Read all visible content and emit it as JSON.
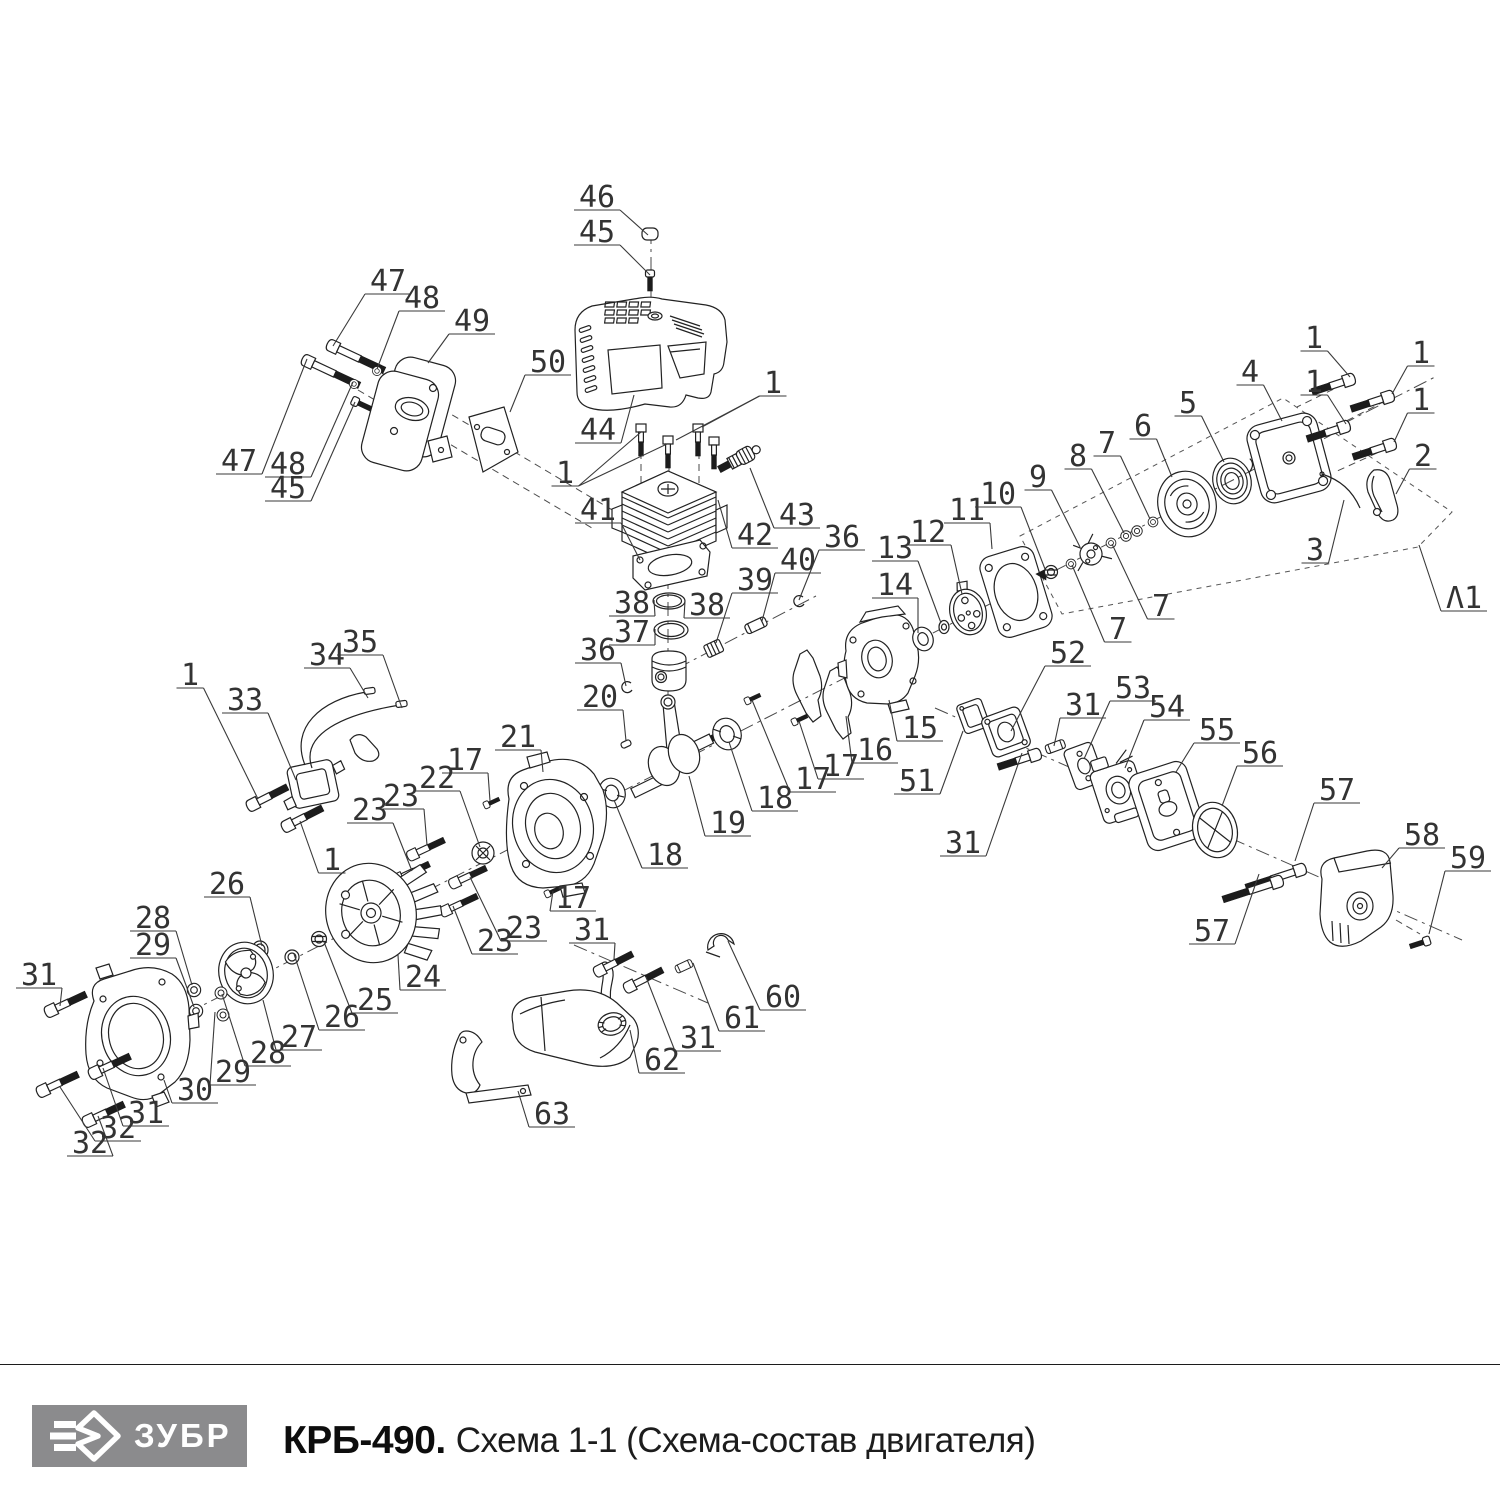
{
  "footer": {
    "brand": "ЗУБР",
    "title_model": "КРБ-490.",
    "title_scheme": "Схема 1-1 (Схема-состав двигателя)",
    "logo_bg": "#8b8b8d",
    "logo_fg": "#ffffff"
  },
  "diagram": {
    "description": "Exploded parts view of KRB-490 brushcutter engine",
    "line_color": "#222222",
    "callouts": [
      {
        "n": "46",
        "x": 597,
        "y": 197,
        "tx": 648,
        "ty": 235
      },
      {
        "n": "45",
        "x": 597,
        "y": 232,
        "tx": 650,
        "ty": 275
      },
      {
        "n": "47",
        "x": 388,
        "y": 281,
        "tx": 333,
        "ty": 346
      },
      {
        "n": "48",
        "x": 422,
        "y": 298,
        "tx": 377,
        "ty": 369
      },
      {
        "n": "49",
        "x": 472,
        "y": 321,
        "tx": 428,
        "ty": 363
      },
      {
        "n": "50",
        "x": 548,
        "y": 362,
        "tx": 510,
        "ty": 412
      },
      {
        "n": "47",
        "x": 239,
        "y": 461,
        "tx": 307,
        "ty": 359
      },
      {
        "n": "48",
        "x": 288,
        "y": 464,
        "tx": 353,
        "ty": 382
      },
      {
        "n": "45",
        "x": 288,
        "y": 488,
        "tx": 355,
        "ty": 402
      },
      {
        "n": "44",
        "x": 598,
        "y": 430,
        "tx": 634,
        "ty": 395
      },
      {
        "n": "1",
        "x": 773,
        "y": 383,
        "tx": 702,
        "ty": 427,
        "tx2": 676,
        "ty2": 440
      },
      {
        "n": "1",
        "x": 565,
        "y": 473,
        "tx": 641,
        "ty": 432,
        "tx2": 667,
        "ty2": 444
      },
      {
        "n": "43",
        "x": 797,
        "y": 515,
        "tx": 750,
        "ty": 468
      },
      {
        "n": "42",
        "x": 755,
        "y": 535,
        "tx": 718,
        "ty": 500
      },
      {
        "n": "41",
        "x": 598,
        "y": 510,
        "tx": 640,
        "ty": 560
      },
      {
        "n": "38",
        "x": 632,
        "y": 603,
        "tx": 654,
        "ty": 600
      },
      {
        "n": "38",
        "x": 707,
        "y": 605,
        "tx": 685,
        "ty": 601
      },
      {
        "n": "37",
        "x": 632,
        "y": 632,
        "tx": 655,
        "ty": 629
      },
      {
        "n": "39",
        "x": 755,
        "y": 580,
        "tx": 716,
        "ty": 643
      },
      {
        "n": "40",
        "x": 798,
        "y": 560,
        "tx": 762,
        "ty": 621
      },
      {
        "n": "36",
        "x": 842,
        "y": 537,
        "tx": 799,
        "ty": 600
      },
      {
        "n": "36",
        "x": 598,
        "y": 650,
        "tx": 626,
        "ty": 686
      },
      {
        "n": "20",
        "x": 600,
        "y": 697,
        "tx": 626,
        "ty": 741
      },
      {
        "n": "13",
        "x": 895,
        "y": 548,
        "tx": 941,
        "ty": 623
      },
      {
        "n": "12",
        "x": 928,
        "y": 532,
        "tx": 962,
        "ty": 594
      },
      {
        "n": "11",
        "x": 967,
        "y": 510,
        "tx": 992,
        "ty": 549
      },
      {
        "n": "10",
        "x": 998,
        "y": 494,
        "tx": 1045,
        "ty": 569
      },
      {
        "n": "14",
        "x": 895,
        "y": 585,
        "tx": 918,
        "ty": 633
      },
      {
        "n": "15",
        "x": 920,
        "y": 728,
        "tx": 889,
        "ty": 700
      },
      {
        "n": "16",
        "x": 875,
        "y": 750,
        "tx": 846,
        "ty": 716
      },
      {
        "n": "17",
        "x": 841,
        "y": 766,
        "tx": 799,
        "ty": 721
      },
      {
        "n": "17",
        "x": 813,
        "y": 779,
        "tx": 752,
        "ty": 700
      },
      {
        "n": "9",
        "x": 1038,
        "y": 477,
        "tx": 1080,
        "ty": 547
      },
      {
        "n": "8",
        "x": 1078,
        "y": 456,
        "tx": 1124,
        "ty": 533
      },
      {
        "n": "7",
        "x": 1107,
        "y": 443,
        "tx": 1150,
        "ty": 519
      },
      {
        "n": "6",
        "x": 1143,
        "y": 426,
        "tx": 1172,
        "ty": 477
      },
      {
        "n": "5",
        "x": 1188,
        "y": 403,
        "tx": 1224,
        "ty": 462
      },
      {
        "n": "4",
        "x": 1250,
        "y": 372,
        "tx": 1282,
        "ty": 421
      },
      {
        "n": "1",
        "x": 1314,
        "y": 338,
        "tx": 1350,
        "ty": 377
      },
      {
        "n": "1",
        "x": 1421,
        "y": 353,
        "tx": 1392,
        "ty": 394
      },
      {
        "n": "1",
        "x": 1314,
        "y": 382,
        "tx": 1346,
        "ty": 424
      },
      {
        "n": "1",
        "x": 1421,
        "y": 400,
        "tx": 1394,
        "ty": 442
      },
      {
        "n": "2",
        "x": 1423,
        "y": 456,
        "tx": 1396,
        "ty": 494
      },
      {
        "n": "3",
        "x": 1315,
        "y": 550,
        "tx": 1344,
        "ty": 500
      },
      {
        "n": "Λ1",
        "x": 1464,
        "y": 598,
        "tx": 1419,
        "ty": 545
      },
      {
        "n": "7",
        "x": 1161,
        "y": 606,
        "tx": 1112,
        "ty": 544
      },
      {
        "n": "7",
        "x": 1118,
        "y": 629,
        "tx": 1072,
        "ty": 565
      },
      {
        "n": "51",
        "x": 917,
        "y": 781,
        "tx": 963,
        "ty": 731
      },
      {
        "n": "52",
        "x": 1068,
        "y": 653,
        "tx": 1011,
        "ty": 731
      },
      {
        "n": "31",
        "x": 963,
        "y": 843,
        "tx": 1022,
        "ty": 753
      },
      {
        "n": "31",
        "x": 1083,
        "y": 705,
        "tx": 1054,
        "ty": 746
      },
      {
        "n": "53",
        "x": 1133,
        "y": 688,
        "tx": 1084,
        "ty": 759
      },
      {
        "n": "54",
        "x": 1167,
        "y": 707,
        "tx": 1125,
        "ty": 768
      },
      {
        "n": "55",
        "x": 1217,
        "y": 730,
        "tx": 1176,
        "ty": 772
      },
      {
        "n": "56",
        "x": 1260,
        "y": 753,
        "tx": 1222,
        "ty": 806
      },
      {
        "n": "57",
        "x": 1337,
        "y": 790,
        "tx": 1295,
        "ty": 861
      },
      {
        "n": "57",
        "x": 1212,
        "y": 931,
        "tx": 1259,
        "ty": 874
      },
      {
        "n": "58",
        "x": 1422,
        "y": 835,
        "tx": 1382,
        "ty": 868
      },
      {
        "n": "59",
        "x": 1468,
        "y": 858,
        "tx": 1429,
        "ty": 934
      },
      {
        "n": "1",
        "x": 190,
        "y": 675,
        "tx": 258,
        "ty": 799
      },
      {
        "n": "33",
        "x": 245,
        "y": 700,
        "tx": 296,
        "ty": 780
      },
      {
        "n": "34",
        "x": 327,
        "y": 655,
        "tx": 368,
        "ty": 698
      },
      {
        "n": "35",
        "x": 360,
        "y": 642,
        "tx": 402,
        "ty": 708
      },
      {
        "n": "1",
        "x": 332,
        "y": 860,
        "tx": 300,
        "ty": 821
      },
      {
        "n": "21",
        "x": 518,
        "y": 737,
        "tx": 543,
        "ty": 772
      },
      {
        "n": "17",
        "x": 465,
        "y": 760,
        "tx": 490,
        "ty": 801
      },
      {
        "n": "22",
        "x": 437,
        "y": 778,
        "tx": 480,
        "ty": 847
      },
      {
        "n": "23",
        "x": 401,
        "y": 796,
        "tx": 427,
        "ty": 845
      },
      {
        "n": "23",
        "x": 370,
        "y": 810,
        "tx": 412,
        "ty": 871
      },
      {
        "n": "26",
        "x": 227,
        "y": 884,
        "tx": 262,
        "ty": 946
      },
      {
        "n": "24",
        "x": 423,
        "y": 977,
        "tx": 398,
        "ty": 955
      },
      {
        "n": "25",
        "x": 375,
        "y": 1000,
        "tx": 324,
        "ty": 942
      },
      {
        "n": "26",
        "x": 342,
        "y": 1017,
        "tx": 294,
        "ty": 954
      },
      {
        "n": "27",
        "x": 299,
        "y": 1037,
        "tx": 263,
        "ty": 1000
      },
      {
        "n": "28",
        "x": 153,
        "y": 918,
        "tx": 192,
        "ty": 985
      },
      {
        "n": "29",
        "x": 153,
        "y": 945,
        "tx": 194,
        "ty": 1007
      },
      {
        "n": "28",
        "x": 268,
        "y": 1053,
        "tx": 222,
        "ty": 994
      },
      {
        "n": "29",
        "x": 233,
        "y": 1072,
        "tx": 215,
        "ty": 1012
      },
      {
        "n": "30",
        "x": 195,
        "y": 1090,
        "tx": 164,
        "ty": 1080
      },
      {
        "n": "31",
        "x": 39,
        "y": 975,
        "tx": 60,
        "ty": 1006
      },
      {
        "n": "31",
        "x": 146,
        "y": 1113,
        "tx": 103,
        "ty": 1068
      },
      {
        "n": "32",
        "x": 118,
        "y": 1128,
        "tx": 60,
        "ty": 1087
      },
      {
        "n": "32",
        "x": 90,
        "y": 1143,
        "tx": 98,
        "ty": 1116
      },
      {
        "n": "18",
        "x": 665,
        "y": 855,
        "tx": 614,
        "ty": 800
      },
      {
        "n": "18",
        "x": 775,
        "y": 798,
        "tx": 729,
        "ty": 742
      },
      {
        "n": "19",
        "x": 728,
        "y": 823,
        "tx": 689,
        "ty": 776
      },
      {
        "n": "17",
        "x": 573,
        "y": 898,
        "tx": 553,
        "ty": 891
      },
      {
        "n": "31",
        "x": 592,
        "y": 930,
        "tx": 614,
        "ty": 959
      },
      {
        "n": "31",
        "x": 698,
        "y": 1038,
        "tx": 646,
        "ty": 977
      },
      {
        "n": "62",
        "x": 662,
        "y": 1060,
        "tx": 630,
        "ty": 1030
      },
      {
        "n": "63",
        "x": 552,
        "y": 1114,
        "tx": 518,
        "ty": 1091
      },
      {
        "n": "60",
        "x": 783,
        "y": 997,
        "tx": 728,
        "ty": 941
      },
      {
        "n": "61",
        "x": 742,
        "y": 1018,
        "tx": 693,
        "ty": 963
      },
      {
        "n": "23",
        "x": 495,
        "y": 941,
        "tx": 453,
        "ty": 906
      },
      {
        "n": "23",
        "x": 524,
        "y": 928,
        "tx": 470,
        "ty": 877
      }
    ]
  }
}
